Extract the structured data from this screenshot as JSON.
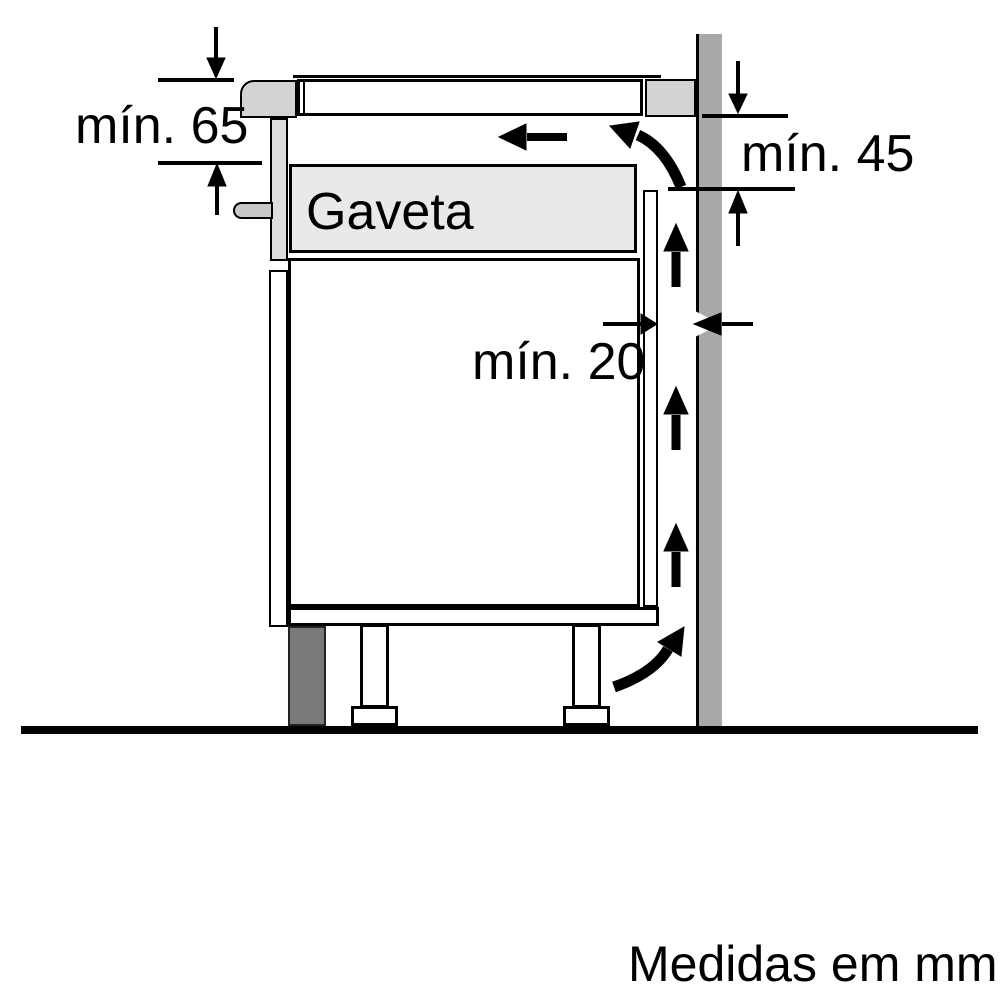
{
  "diagram": {
    "type": "appliance-installation-clearance-side-view",
    "labels": {
      "dim_hob_depth": "mín. 65",
      "dim_rear_vent": "mín. 45",
      "dim_wall_gap": "mín. 20",
      "drawer": "Gaveta",
      "footer": "Medidas em mm"
    },
    "colors": {
      "background": "#ffffff",
      "line": "#000000",
      "wall": "#a9a9a9",
      "worktop_section": "#d3d3d3",
      "drawer_fill": "#e9e9e9",
      "drawer_front_panel": "#dedede",
      "handle": "#c8c8c8",
      "plinth": "#7a7a7a"
    },
    "icons": [
      "dimension-arrow-down-left-icon",
      "dimension-arrow-up-left-icon",
      "dimension-arrow-down-right-icon",
      "dimension-arrow-up-right-icon",
      "clearance-arrow-right-icon",
      "clearance-arrow-left-icon",
      "airflow-arrow-left-icon",
      "airflow-curved-arrow-top-icon",
      "airflow-arrow-up-1-icon",
      "airflow-arrow-up-2-icon",
      "airflow-arrow-up-3-icon",
      "airflow-curved-arrow-bottom-icon"
    ]
  }
}
